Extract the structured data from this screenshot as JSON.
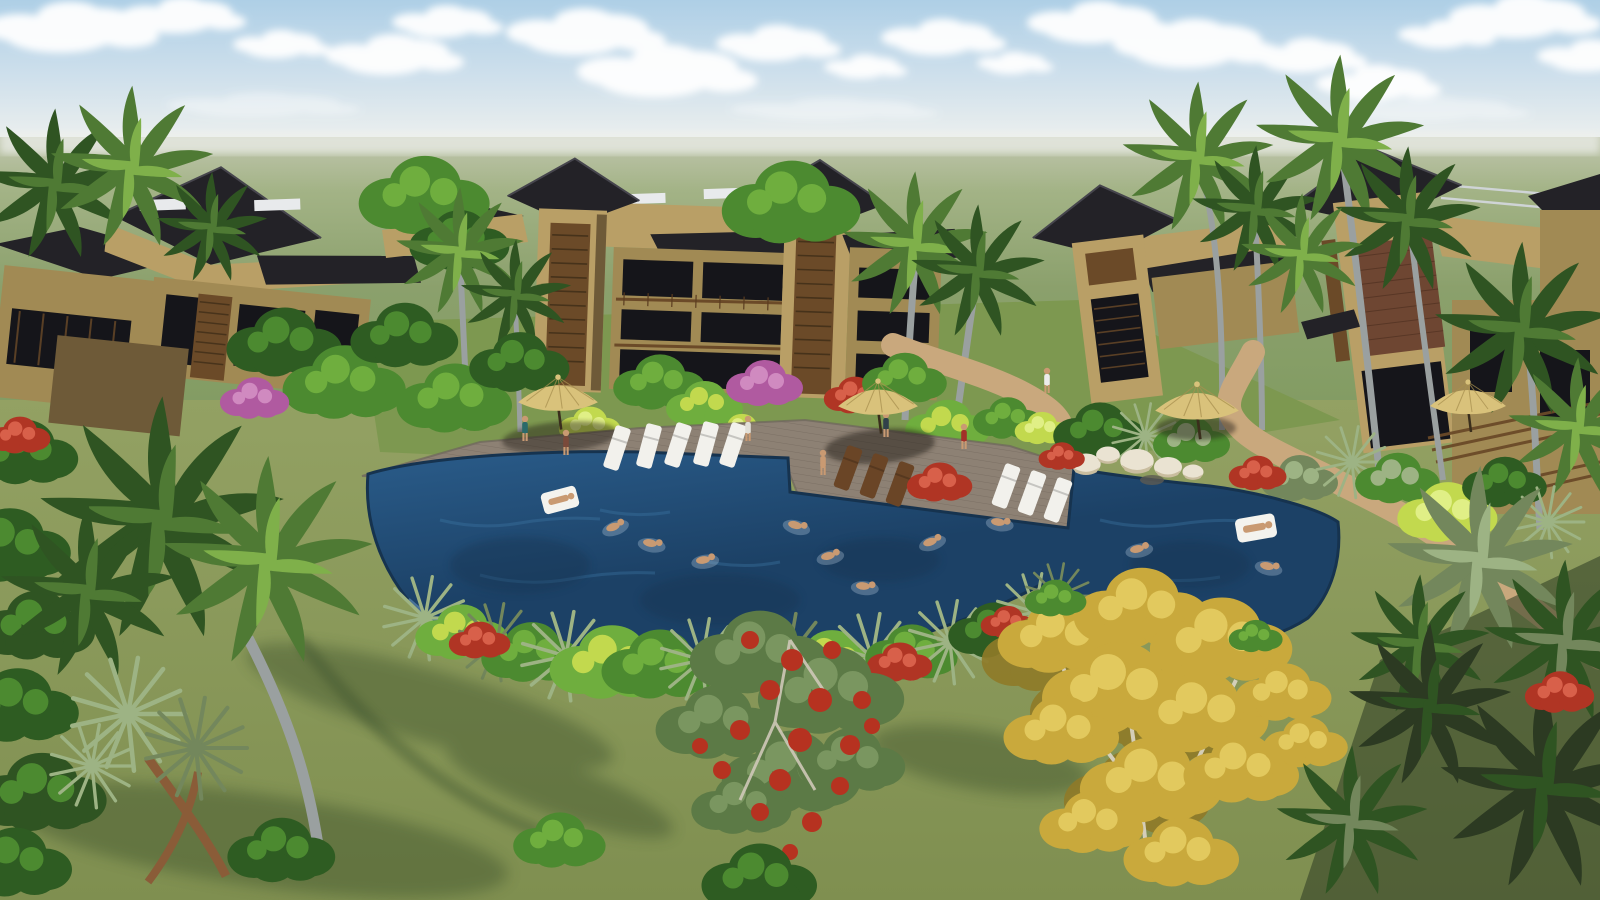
{
  "scene": {
    "title": "Tropical resort pool — 3D architectural rendering",
    "description": "Aerial 3D rendering of a tropical apartment resort: tan multi-storey buildings with dark pyramidal hip roofs and timber-slat stair towers surround a free-form deep-blue swimming pool. A grey timber deck holds white and wooden lounge chairs and thatched umbrellas; swimmers and two white pool floats are in the water; white boulders, red poinsettias, chartreuse shrubs, winding sand paths, many palm trees, a red-flowering flame tree and a large golden-yellow tree fill the gardens under a pale blue sky with white clouds above a flat green horizon.",
    "time_of_day": "midday",
    "sky": "pale blue with scattered white cumulus clouds",
    "horizon": "flat hazy green plain"
  },
  "inventory": {
    "buildings": 8,
    "pyramid_roof_towers": 6,
    "rooftop_canopies": 4,
    "thatch_umbrellas": 4,
    "white_loungers": 8,
    "wooden_loungers": 3,
    "swimmers": 10,
    "pool_floats": 2,
    "standing_people": 7,
    "boulders": 5,
    "flame_trees": 1,
    "yellow_trees": 1,
    "palm_trees": "numerous coconut, royal and fan palms"
  },
  "palette": {
    "sky_top": "#aecfe6",
    "sky_mid": "#cfe0ec",
    "sky_horizon": "#edf0ee",
    "cloud": "#ffffff",
    "field_far": "#c0c6ae",
    "field_mid": "#a3b386",
    "field": "#8ba06c",
    "field_near": "#7e9a5e",
    "ground_hi": "#93a163",
    "ground_lo": "#7f8f50",
    "grass_dark": "#5f7440",
    "shadow_green": "#2c3a22",
    "roof_dark": "#232227",
    "roof_light": "#46454d",
    "wall_light": "#b99f66",
    "wall_mid": "#a18a54",
    "wall_dark": "#6e5a38",
    "window_dark": "#15151a",
    "frame_light": "#cfd4d6",
    "slat_brown": "#6b4a28",
    "canopy_white": "#e8eaec",
    "brick": "#6e4632",
    "trunk_gray": "#9aa0a0",
    "trunk_brown": "#8a5c38",
    "palm_dark": "#2f5422",
    "palm_mid": "#4f7a34",
    "palm_light": "#7fb04a",
    "sage": "#9db384",
    "sage_dark": "#73875c",
    "bush_bright": "#6fae3e",
    "bush_mid": "#4c8a30",
    "bush_dark": "#2e5c22",
    "chartreuse": "#c2d94e",
    "magenta": "#b05aa0",
    "flame_green": "#5c7a46",
    "flame_red": "#b63220",
    "red_bush": "#b03524",
    "yellow_tree": "#c9a93c",
    "yellow_light": "#e2c95e",
    "yellow_dark": "#8f7a28",
    "branch_pale": "#d8d2c0",
    "deck": "#8d8174",
    "deck_edge": "#6e655c",
    "pool_deep": "#1c4166",
    "pool_mid": "#2a5c8a",
    "pool_light": "#3f7aa8",
    "pool_edge": "#16334f",
    "tile": "#6f9cc4",
    "sand": "#c9a87d",
    "sand_dark": "#8a6a4e",
    "skin": "#c99a72",
    "lounger_white": "#f2f1ec",
    "wood_lounger": "#6a4526",
    "umbrella": "#d9c27b",
    "umbrella_dark": "#a8904f",
    "pole": "#3a2e1c",
    "rock_light": "#eae3d2",
    "rock_mid": "#c9bd9f"
  }
}
